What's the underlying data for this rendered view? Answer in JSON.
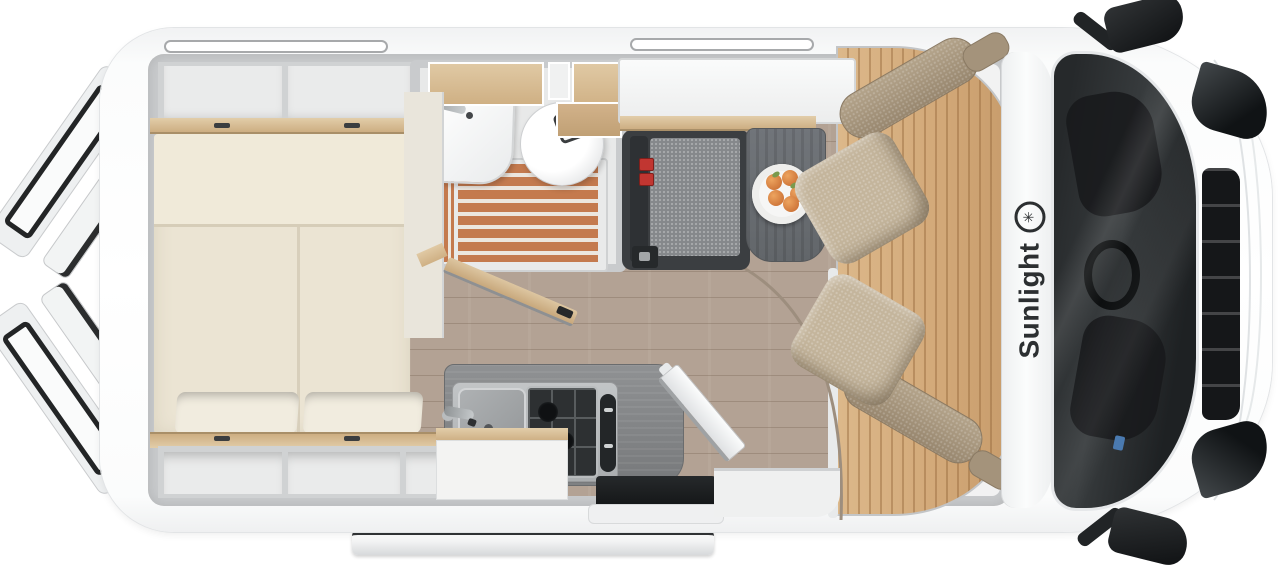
{
  "brand": {
    "name": "Sunlight",
    "logo_icon": "sun-star-icon",
    "logo_glyph": "✳"
  },
  "palette": {
    "body_white": "#fbfcfc",
    "wall_gray": "#c9cbcd",
    "bed_cream": "#ebe4d3",
    "wood_beech_trim": "#cdae82",
    "shower_slats": "#c47a4e",
    "living_floor": "#b3a294",
    "cab_floor": "#d2a878",
    "seat_beige": "#c4b59c",
    "bench_gray": "#85888b",
    "table_gray": "#62666a",
    "seatbelt_red": "#c13631",
    "windshield_dark": "#1e2123",
    "fruit_orange": "#c4662c"
  }
}
